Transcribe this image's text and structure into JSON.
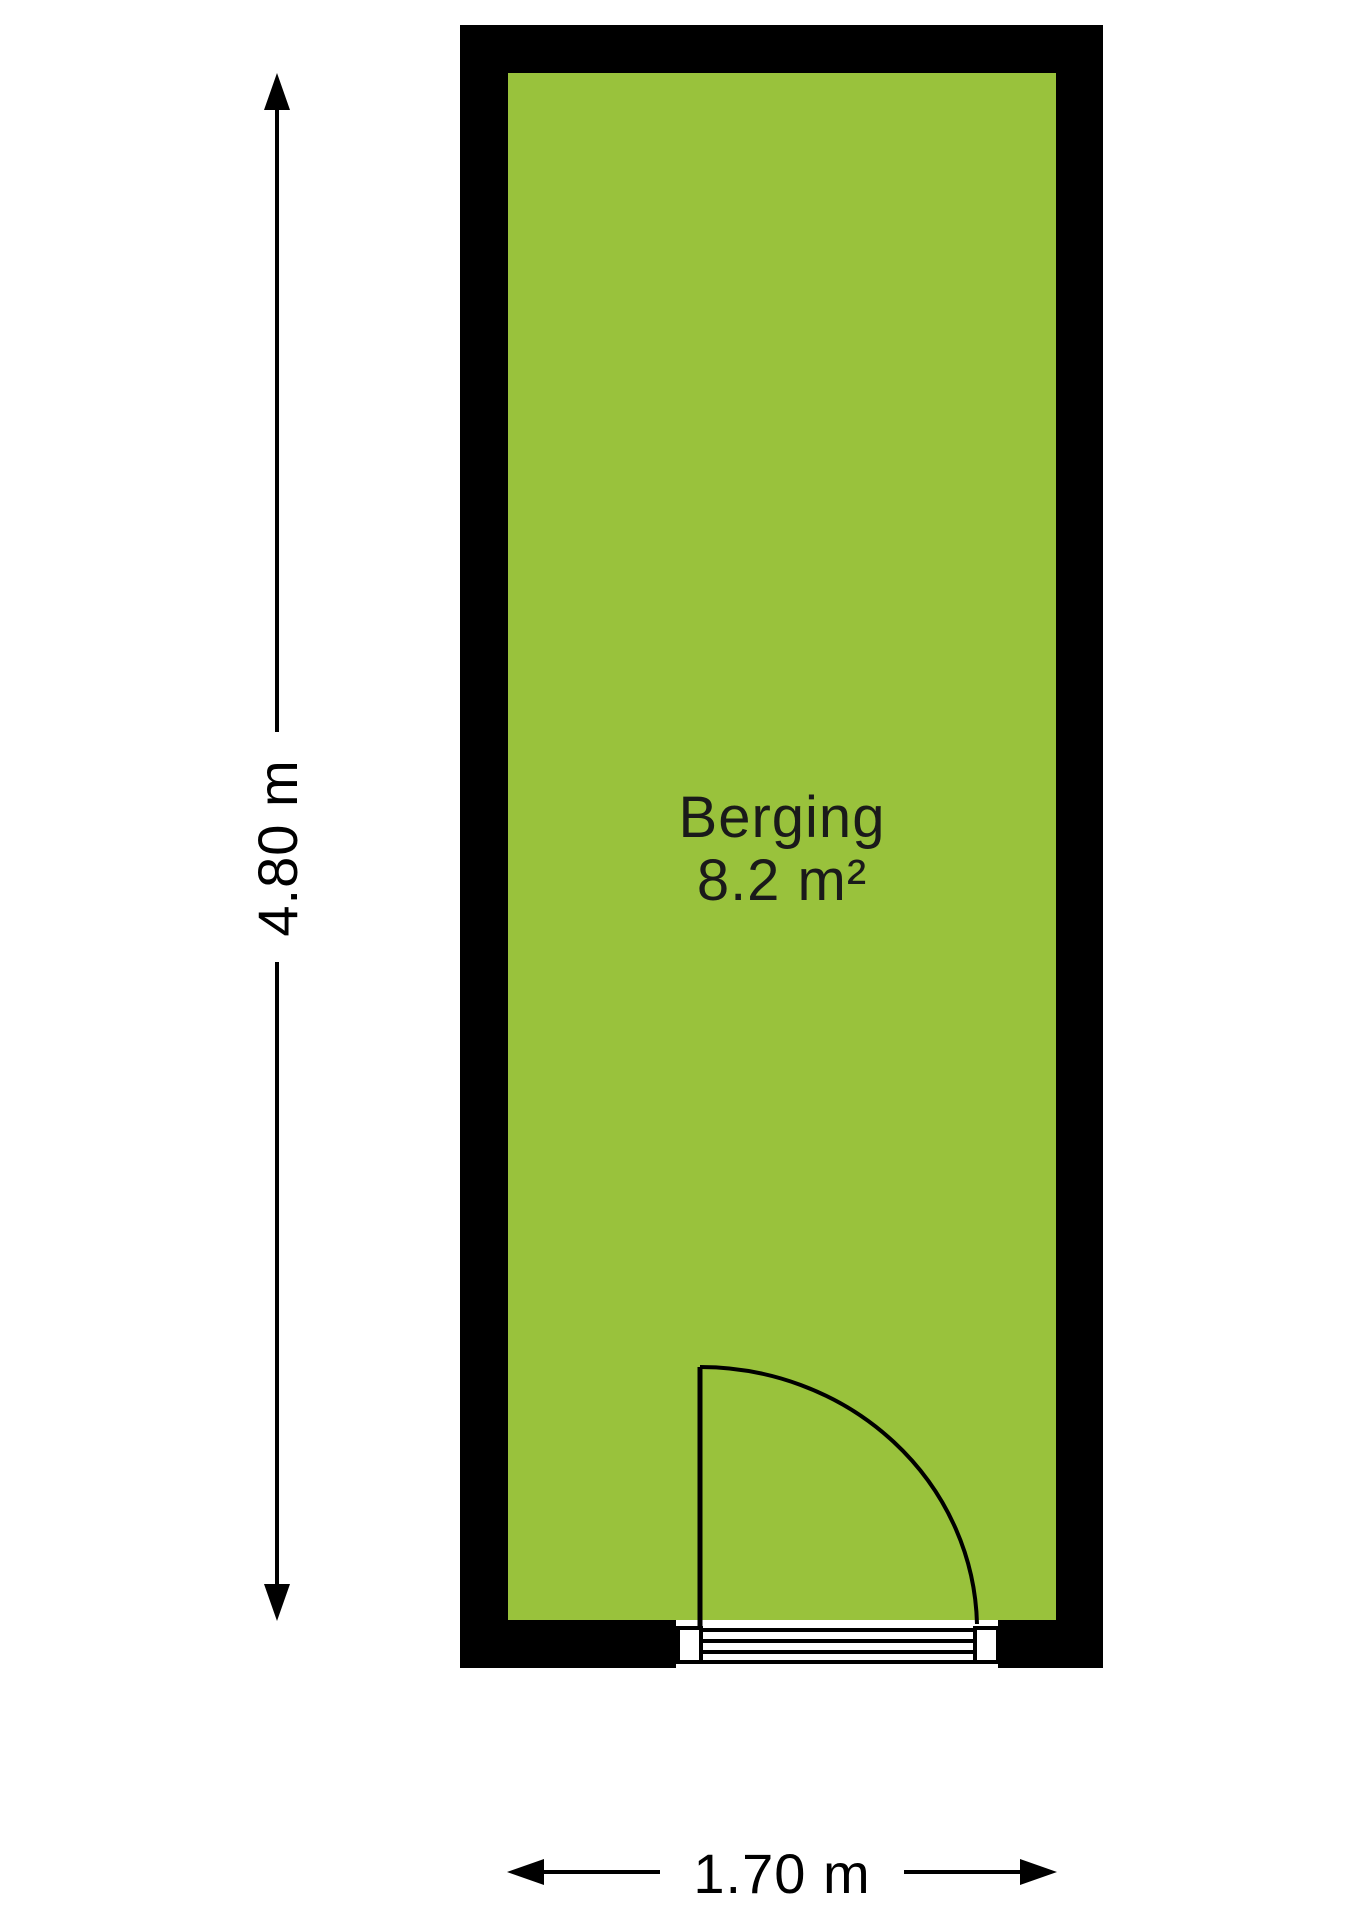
{
  "floorplan": {
    "room": {
      "name": "Berging",
      "area": "8.2 m²"
    },
    "dimensions": {
      "height_label": "4.80 m",
      "width_label": "1.70 m"
    },
    "colors": {
      "floor": "#99C23C",
      "wall": "#000000",
      "background": "#FFFFFF"
    },
    "icons": [
      "dimension-arrow-up-icon",
      "dimension-arrow-down-icon",
      "dimension-arrow-left-icon",
      "dimension-arrow-right-icon"
    ]
  }
}
